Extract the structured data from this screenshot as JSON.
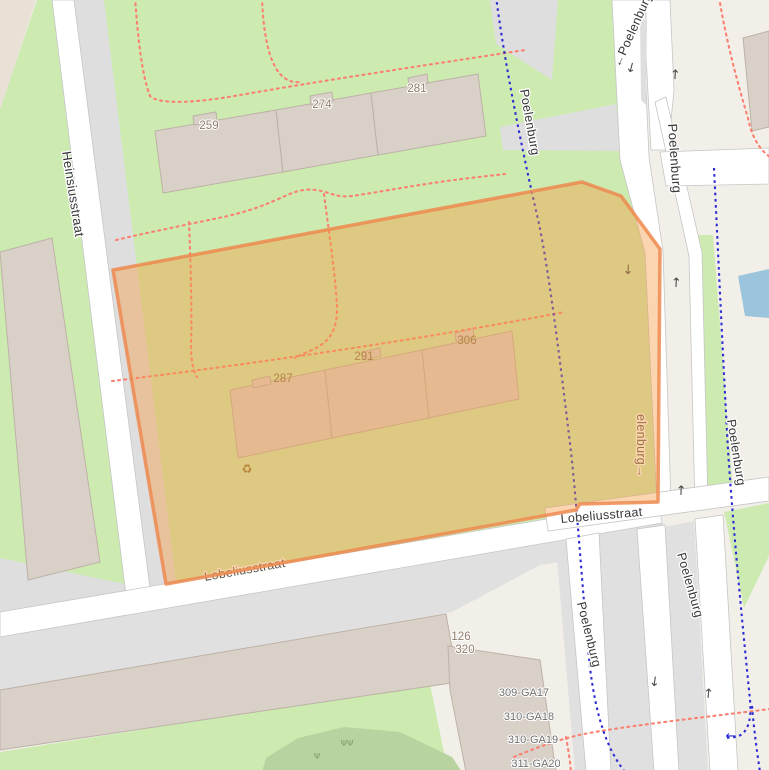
{
  "map": {
    "streets": {
      "heinsiusstraat": "Heinsiusstraat",
      "poelenburg_top": "←Poelenburg",
      "poelenburg_path_nw": "Poelenburg",
      "poelenburg_main_n": "Poelenburg",
      "poelenburg_inner": "elenburg→",
      "lobeliusstraat_sw": "Lobeliusstraat",
      "lobeliusstraat_se": "Lobeliusstraat",
      "poelenburg_sw": "Poelenburg",
      "poelenburg_se": "Poelenburg",
      "poelenburg_cycleway": "Poelenburg"
    },
    "house_numbers": {
      "n259": "259",
      "n274": "274",
      "n281": "281",
      "n287": "287",
      "n291": "291",
      "n306": "306",
      "n126": "126",
      "n320": "320"
    },
    "parcels": [
      "309-GA17",
      "310-GA18",
      "310-GA19",
      "311-GA20"
    ],
    "icons": {
      "recycling": "♻",
      "scrub_pair": "ΨΨ",
      "scrub_single": "Ψ"
    },
    "arrows": {
      "up": "↑",
      "down": "↓",
      "left": "←"
    },
    "colors": {
      "land": "#f2efe9",
      "grass": "#cdebb0",
      "water": "#9cc5dd",
      "building": "#d9d0c8",
      "road": "#ffffff",
      "highlight_fill": "#f59b42",
      "highlight_border": "#ed8a50",
      "cycleway_blue": "#2b2bd4",
      "footpath_red": "#fa8072"
    }
  }
}
